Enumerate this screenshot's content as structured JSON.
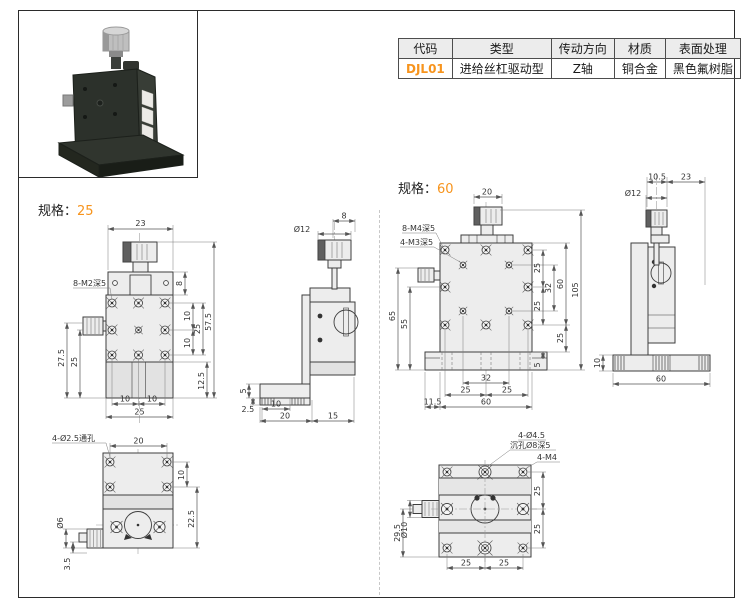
{
  "info_table": {
    "headers": [
      "代码",
      "类型",
      "传动方向",
      "材质",
      "表面处理"
    ],
    "row": {
      "code": "DJL01",
      "type": "进给丝杠驱动型",
      "direction": "Z轴",
      "material": "铜合金",
      "finish": "黑色氟树脂"
    }
  },
  "accent_color": "#F7941D",
  "spec25": {
    "label": "规格：",
    "size": "25",
    "front": {
      "note": "8-M2深5",
      "d23": "23",
      "d8": "8",
      "d575": "57.5",
      "d10a": "10",
      "d25r": "25",
      "d10b": "10",
      "d125": "12.5",
      "d275": "27.5",
      "d25l": "25",
      "d10c": "10",
      "d10d": "10",
      "d25b": "25"
    },
    "side": {
      "d8": "8",
      "dia": "Ø12",
      "d5": "5",
      "d25": "2.5",
      "d10": "10",
      "d20": "20",
      "d15": "15"
    },
    "bottom": {
      "note": "4-Ø2.5通孔",
      "d20": "20",
      "d10": "10",
      "d225": "22.5",
      "dia": "Ø6",
      "d35": "3.5"
    }
  },
  "spec60": {
    "label": "规格：",
    "size": "60",
    "front": {
      "note1": "8-M4深5",
      "note2": "4-M3深5",
      "d20": "20",
      "d25a": "25",
      "d32r": "32",
      "d25b": "25",
      "d60r": "60",
      "d105": "105",
      "d25c": "25",
      "d5": "5",
      "d65": "65",
      "d55": "55",
      "d115": "11.5",
      "d32b": "32",
      "d25d": "25",
      "d25e": "25",
      "d60b": "60"
    },
    "side": {
      "d105": "10.5",
      "d23": "23",
      "dia": "Ø12",
      "d10": "10",
      "d60": "60"
    },
    "bottom": {
      "note1": "4-Ø4.5",
      "note2": "沉孔Ø8深5",
      "note3": "4-M4",
      "d25a": "25",
      "d25b": "25",
      "d25c": "25",
      "d25d": "25",
      "d295": "29.5",
      "dia": "Ø10"
    }
  }
}
